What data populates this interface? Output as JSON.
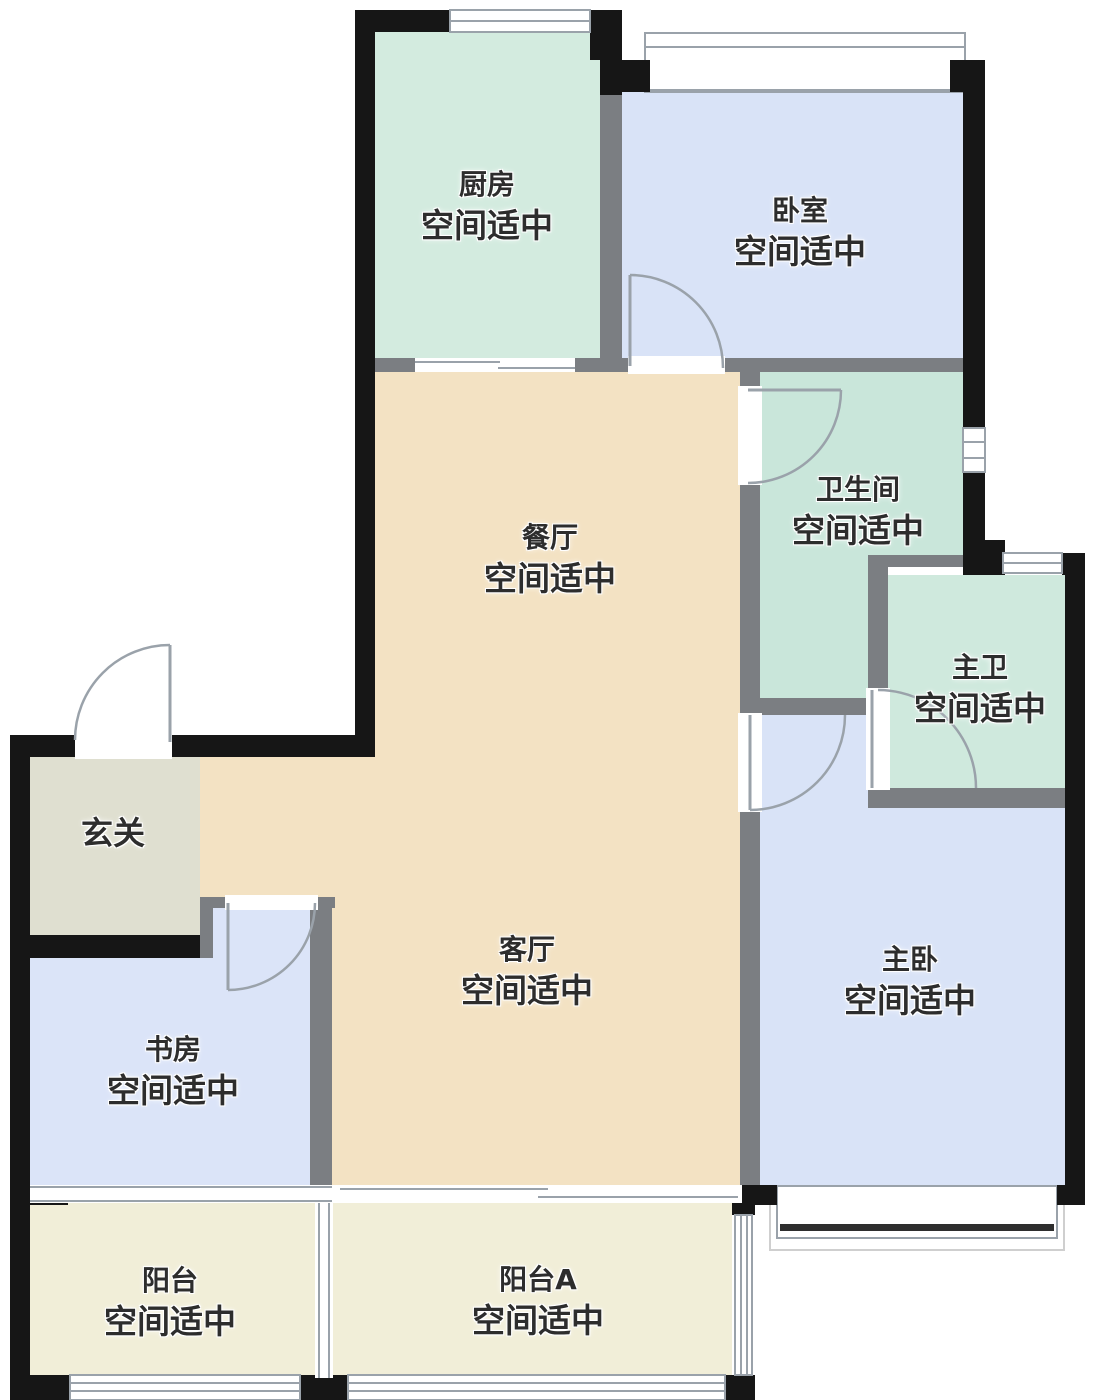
{
  "colors": {
    "wall": "#161616",
    "inner_wall": "#7b7e82",
    "kitchen": "#d3ebdf",
    "bedroom": "#d9e3f7",
    "bathroom": "#c9e6da",
    "master_bath": "#cfe9dd",
    "dining_living": "#f3e2c3",
    "entry": "#dfdfd0",
    "study": "#dbe4f8",
    "master_bedroom": "#d9e3f7",
    "balcony": "#f1eed8",
    "text": "#2d2d2d"
  },
  "rooms": {
    "kitchen": {
      "name": "厨房",
      "status": "空间适中"
    },
    "bedroom": {
      "name": "卧室",
      "status": "空间适中"
    },
    "bathroom": {
      "name": "卫生间",
      "status": "空间适中"
    },
    "master_bath": {
      "name": "主卫",
      "status": "空间适中"
    },
    "dining": {
      "name": "餐厅",
      "status": "空间适中"
    },
    "entry": {
      "name": "玄关"
    },
    "living": {
      "name": "客厅",
      "status": "空间适中"
    },
    "study": {
      "name": "书房",
      "status": "空间适中"
    },
    "master_bedroom": {
      "name": "主卧",
      "status": "空间适中"
    },
    "balcony": {
      "name": "阳台",
      "status": "空间适中"
    },
    "balcony_a": {
      "name": "阳台A",
      "status": "空间适中"
    }
  }
}
